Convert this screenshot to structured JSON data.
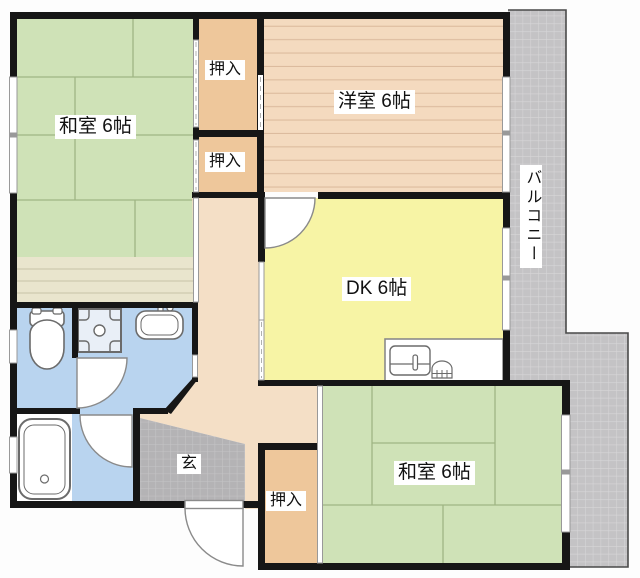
{
  "plan": {
    "title": "2DK apartment floor plan",
    "rooms": {
      "washitsu_top": {
        "label": "和室 6帖"
      },
      "yoshitsu": {
        "label": "洋室 6帖"
      },
      "dk": {
        "label": "DK 6帖"
      },
      "washitsu_bottom": {
        "label": "和室 6帖"
      },
      "balcony": {
        "label": "バルコニー"
      },
      "genkan": {
        "label": "玄"
      },
      "oshiire_top_1": {
        "label": "押入"
      },
      "oshiire_top_2": {
        "label": "押入"
      },
      "oshiire_bottom": {
        "label": "押入"
      }
    },
    "fixtures": {
      "toilet": "toilet-icon",
      "washing_machine_pan": "washing-machine-pan-icon",
      "basin": "wash-basin-icon",
      "bathtub": "bathtub-icon",
      "kitchen_sink": "kitchen-sink-icon"
    },
    "colors": {
      "tatami": "#cfe2b7",
      "tatami_line": "#9fb584",
      "tatami_edge": "#e9e5cd",
      "tatami_edge_line": "#cfcbae",
      "closet": "#eec79b",
      "wood_floor": "#f4dabf",
      "wood_line": "#dcbb9e",
      "dk_floor": "#f7f4a5",
      "hallway": "#f4dfc6",
      "water_floor": "#b9d4ef",
      "bath_floor": "#ffffff",
      "balcony_floor": "#c4c3c5",
      "balcony_line": "#d7d6d8",
      "genkan_floor": "#b4b3b5",
      "genkan_line": "#c5c4c6",
      "wall": "#161616",
      "fixture_line": "#6b6b6b",
      "opening_line": "#999999"
    }
  }
}
